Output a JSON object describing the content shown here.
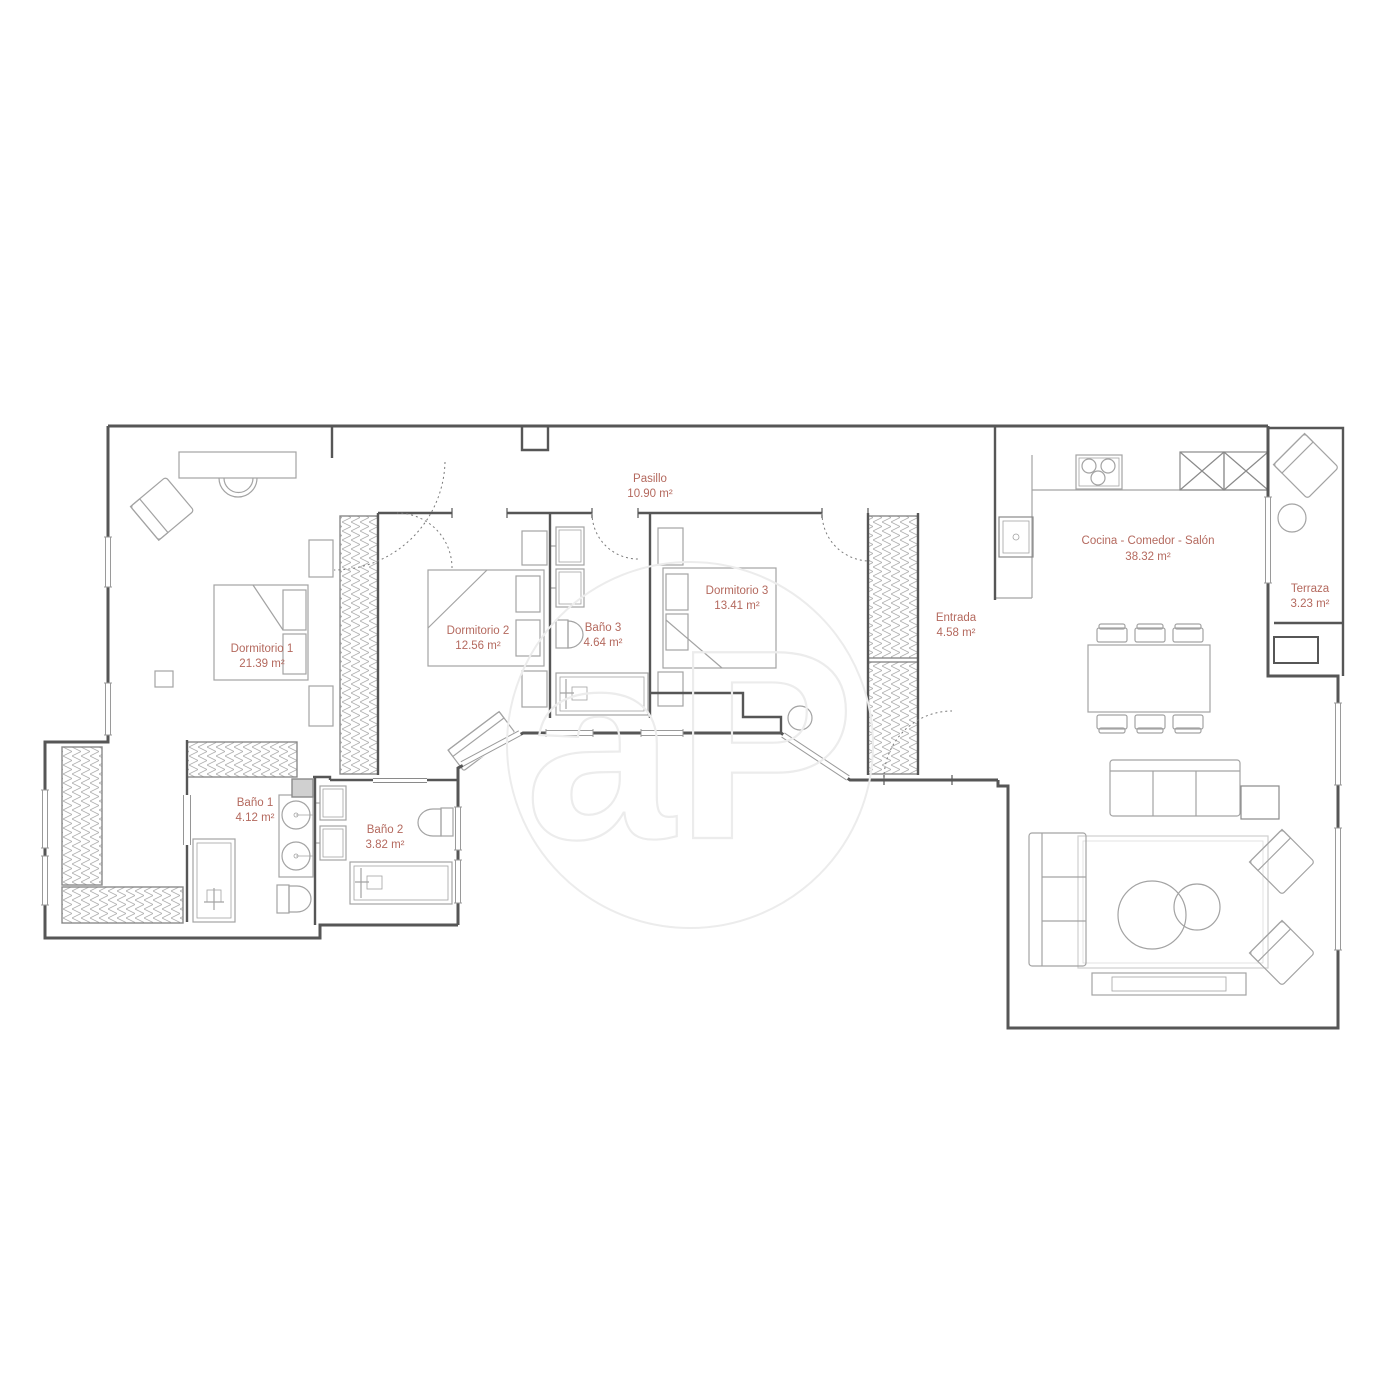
{
  "plan": {
    "watermark": {
      "text": "aP"
    },
    "colors": {
      "label": "#b4695e",
      "wall": "#565656",
      "furniture": "#a3a3a3",
      "watermark": "#ececec"
    },
    "rooms": [
      {
        "id": "dormitorio-1",
        "name": "Dormitorio 1",
        "area": "21.39 m²"
      },
      {
        "id": "dormitorio-2",
        "name": "Dormitorio 2",
        "area": "12.56 m²"
      },
      {
        "id": "dormitorio-3",
        "name": "Dormitorio 3",
        "area": "13.41 m²"
      },
      {
        "id": "bano-1",
        "name": "Baño 1",
        "area": "4.12 m²"
      },
      {
        "id": "bano-2",
        "name": "Baño 2",
        "area": "3.82 m²"
      },
      {
        "id": "bano-3",
        "name": "Baño 3",
        "area": "4.64 m²"
      },
      {
        "id": "pasillo",
        "name": "Pasillo",
        "area": "10.90 m²"
      },
      {
        "id": "entrada",
        "name": "Entrada",
        "area": "4.58 m²"
      },
      {
        "id": "cocina-comedor-salon",
        "name": "Cocina - Comedor - Salón",
        "area": "38.32 m²"
      },
      {
        "id": "terraza",
        "name": "Terraza",
        "area": "3.23 m²"
      }
    ]
  }
}
